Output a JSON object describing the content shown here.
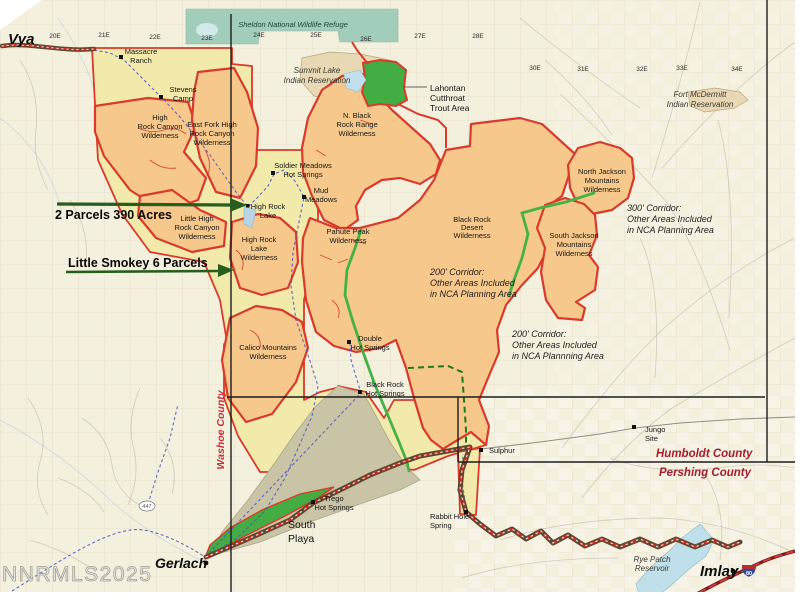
{
  "watermark": "NNRMLS2025",
  "palette": {
    "background": "#f4f0de",
    "refuge_teal": "#a3cdbb",
    "nca_yellow": "#f1eaaa",
    "wilderness_orange": "#f6c88b",
    "boundary_red": "#d93a2b",
    "corridor_green": "#44b244",
    "parcel_green": "#43ad43",
    "playa_gray": "#c9c4a6",
    "county_text_red": "#a51e2d",
    "trail_olive": "#5a4a30",
    "road_blue": "#4953c2",
    "water_blue": "#c3dfeb",
    "callout_arrow_green": "#275e1e"
  },
  "callouts": {
    "parcels": "2 Parcels 390 Acres",
    "smokey": "Little Smokey 6 Parcels"
  },
  "towns": {
    "vya": "Vya",
    "gerlach": "Gerlach",
    "imlay": "Imlay"
  },
  "counties": {
    "washoe": "Washoe County",
    "humboldt": "Humboldt County",
    "pershing": "Pershing County"
  },
  "refuges": {
    "sheldon": "Sheldon National Wildlife Refuge",
    "summit": [
      "Summit Lake",
      "Indian Reservation"
    ],
    "mcdermitt": [
      "Fort McDermitt",
      "Indian Reservation"
    ]
  },
  "lahontan": [
    "Lahontan",
    "Cutthroat",
    "Trout Area"
  ],
  "wilderness": {
    "hrcw": [
      "High",
      "Rock Canyon",
      "Wilderness"
    ],
    "eastfork": [
      "East Fork High",
      "Rock Canyon",
      "Wilderness"
    ],
    "littlehr": [
      "Little High",
      "Rock Canyon",
      "Wilderness"
    ],
    "hrlake": [
      "High Rock",
      "Lake",
      "Wilderness"
    ],
    "nblackrock": [
      "N. Black",
      "Rock Range",
      "Wilderness"
    ],
    "pahute": [
      "Pahute Peak",
      "Wilderness"
    ],
    "brd": [
      "Black Rock",
      "Desert",
      "Wilderness"
    ],
    "calico": [
      "Calico Mountains",
      "Wilderness"
    ],
    "njackson": [
      "North Jackson",
      "Mountains",
      "Wilderness"
    ],
    "sjackson": [
      "South Jackson",
      "Mountains",
      "Wilderness"
    ]
  },
  "corridors": {
    "c300": [
      "300' Corridor:",
      "Other Areas Included",
      "in NCA Planning Area"
    ],
    "c200a": [
      "200' Corridor:",
      "Other Areas Included",
      "in NCA Planning Area"
    ],
    "c200b": [
      "200' Corridor:",
      "Other Areas Included",
      "in NCA Plannning Area"
    ]
  },
  "places": {
    "massacre": [
      "Massacre",
      "Ranch"
    ],
    "stevens": [
      "Stevens",
      "Camp"
    ],
    "soldier": [
      "Soldier Meadows",
      "Hot Springs"
    ],
    "mud": [
      "Mud",
      "Meadows"
    ],
    "hrlake": [
      "High Rock",
      "Lake"
    ],
    "double": [
      "Double",
      "Hot Springs"
    ],
    "brhs": [
      "Black Rock",
      "Hot Springs"
    ],
    "trego": [
      "Trego",
      "Hot Springs"
    ],
    "rabbit": [
      "Rabbit Hole",
      "Spring"
    ],
    "sulphur": "Sulphur",
    "jungo": [
      "Jungo",
      "Site"
    ],
    "southplaya": [
      "South",
      "Playa"
    ],
    "ryepatch": [
      "Rye Patch",
      "Reservoir"
    ]
  },
  "roads": {
    "e20": "20E",
    "e21": "21E",
    "e22": "22E",
    "e23": "23E",
    "e24": "24E",
    "e25": "25E",
    "e26": "26E",
    "e27": "27E",
    "e28": "28E",
    "e30": "30E",
    "e31": "31E",
    "e32": "32E",
    "e33": "33E",
    "e34": "34E",
    "r447": "447",
    "i80": "80"
  }
}
